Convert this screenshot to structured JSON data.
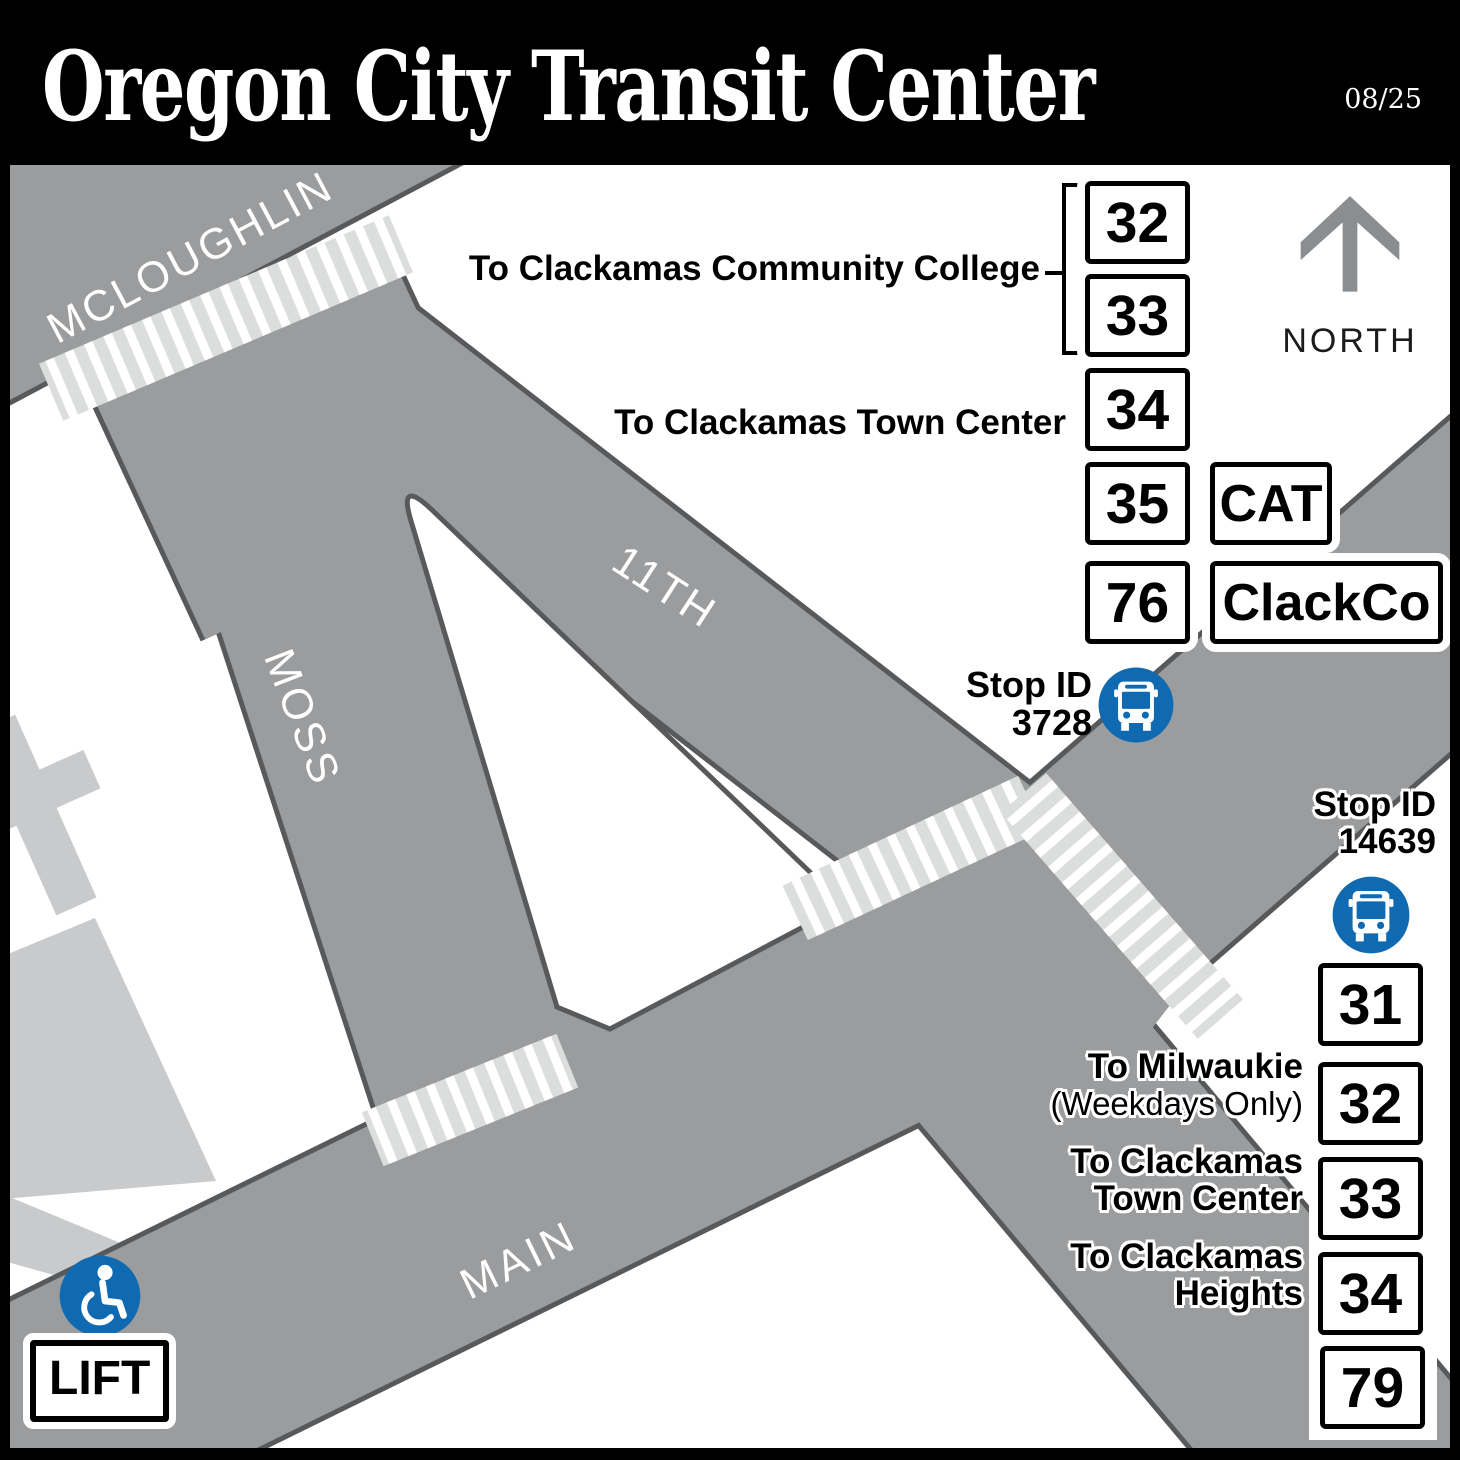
{
  "header": {
    "title": "Oregon City Transit Center",
    "date": "08/25"
  },
  "compass": {
    "label": "NORTH"
  },
  "streets": {
    "mcloughlin": "MCLOUGHLIN",
    "eleventh": "11TH",
    "moss": "MOSS",
    "main": "MAIN"
  },
  "stops": {
    "top": {
      "label": "Stop ID",
      "id": "3728"
    },
    "right": {
      "label": "Stop ID",
      "id": "14639"
    }
  },
  "top_destinations": {
    "college": {
      "label": "To Clackamas Community College"
    },
    "town_center": {
      "label": "To Clackamas Town Center"
    }
  },
  "top_routes": {
    "r32": "32",
    "r33": "33",
    "r34": "34",
    "r35": "35",
    "r76": "76"
  },
  "agencies": {
    "cat": "CAT",
    "clackco": "ClackCo"
  },
  "right_routes": {
    "r31": "31",
    "r32": "32",
    "r33": "33",
    "r34": "34",
    "r79": "79"
  },
  "right_destinations": [
    {
      "line1": "To Milwaukie",
      "line2": "(Weekdays Only)"
    },
    {
      "line1": "To Clackamas",
      "line2": "Town Center"
    },
    {
      "line1": "To Clackamas",
      "line2": "Heights"
    }
  ],
  "lift_label": "LIFT",
  "colors": {
    "road": "#9a9c9e",
    "road_casing": "#58595b",
    "building": "#c8cacc",
    "crosswalk": "#dcdddd",
    "transit_blue": "#0f6ab1"
  }
}
